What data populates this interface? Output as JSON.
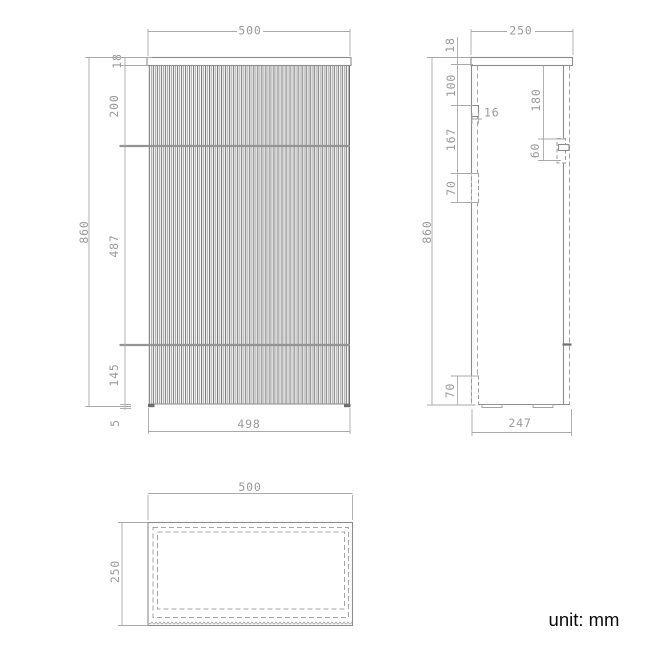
{
  "unit_label": "unit: mm",
  "colors": {
    "background": "#ffffff",
    "object_line": "#8c8c8c",
    "dimension_line": "#a9a9a9",
    "dimension_text": "#9a9a9a",
    "accent_dark": "#6e6e6e",
    "unit_text": "#0a0a0a"
  },
  "drawing": {
    "type": "furniture-technical-drawing",
    "views": [
      "front",
      "side",
      "top"
    ]
  },
  "front": {
    "dims": {
      "top_width": "500",
      "plate_thickness": "18",
      "upper_section": "200",
      "middle_section": "487",
      "lower_section": "145",
      "foot_height": "5",
      "overall_height": "860",
      "bottom_width": "498"
    }
  },
  "side": {
    "dims": {
      "top_depth": "250",
      "plate_thickness": "18",
      "hinge_offset_top": "100",
      "panel_thickness": "16",
      "hinge_spacing": "167",
      "hinge_height_mid": "70",
      "handle_offset": "180",
      "handle_height": "60",
      "overall_height": "860",
      "hinge_height_bottom": "70",
      "bottom_depth": "247"
    }
  },
  "top": {
    "dims": {
      "width": "500",
      "depth": "250"
    }
  }
}
